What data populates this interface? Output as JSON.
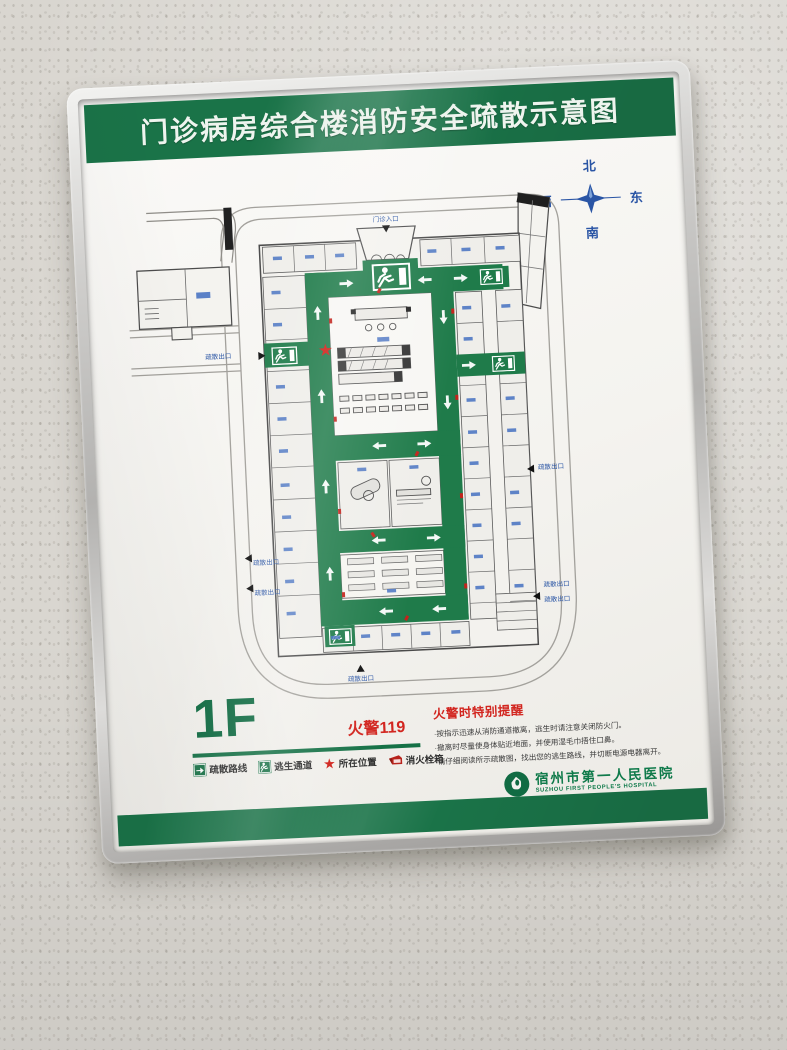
{
  "poster": {
    "title": "门诊病房综合楼消防安全疏散示意图",
    "floor_label": "1F",
    "fire_phone": "火警119",
    "colors": {
      "band_green": "#1a7348",
      "route_green": "#1f7b4a",
      "alert_red": "#cd211a",
      "label_blue": "#2a55a5",
      "frame_silver": "#c6c5c3"
    }
  },
  "compass": {
    "north": "北",
    "south": "南",
    "east": "东",
    "west": "西"
  },
  "map": {
    "exits": {
      "top": "门诊入口",
      "left1": "疏散出口",
      "left2": "疏散出口",
      "left3": "疏散出口",
      "right1": "疏散出口",
      "right2": "疏散出口",
      "right3": "疏散出口",
      "bottom": "疏散出口"
    }
  },
  "legend": {
    "items": [
      {
        "label": "疏散路线"
      },
      {
        "label": "逃生通道"
      },
      {
        "label": "所在位置"
      },
      {
        "label": "消火栓箱"
      }
    ]
  },
  "reminder": {
    "title": "火警时特别提醒",
    "lines": [
      "·按指示迅速从消防通道撤离，逃生时请注意关闭防火门。",
      "·撤离时尽量使身体贴近地面，并使用湿毛巾捂住口鼻。",
      "·请仔细阅读所示疏散图，找出您的逃生路线，并切断电源电器离开。"
    ]
  },
  "hospital": {
    "name_cn": "宿州市第一人民医院",
    "name_en": "SUZHOU FIRST PEOPLE'S HOSPITAL"
  }
}
